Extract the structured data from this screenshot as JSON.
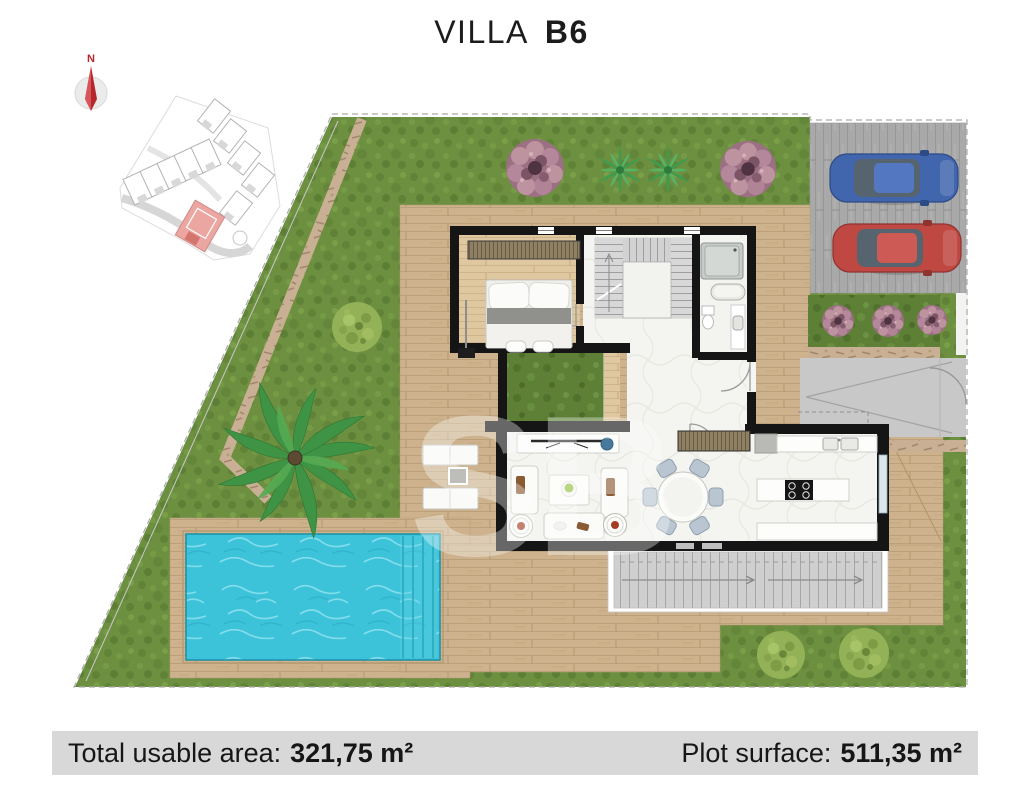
{
  "title": {
    "name": "VILLA",
    "unit": "B6"
  },
  "compass": {
    "label": "N"
  },
  "watermark": {
    "text": "SB"
  },
  "summary": {
    "usable_label": "Total usable area:",
    "usable_value": "321,75 m²",
    "plot_label": "Plot surface:",
    "plot_value": "511,35 m²"
  },
  "palette": {
    "grass": "#6d9040",
    "deck_wood": "#cdb28d",
    "pool_water": "#3cc2d9",
    "driveway": "#a9a9a9",
    "walls": "#151515",
    "compass_red": "#b5272c",
    "highlight_unit": "#eba6a1",
    "car_blue": "#4166ae",
    "car_red": "#bf4842",
    "bar_bg": "#d8d8d8"
  },
  "features": [
    "location-map",
    "compass",
    "lawn",
    "stone-path",
    "palm-tree",
    "swimming-pool",
    "wood-deck",
    "sun-loungers",
    "villa-floorplan",
    "bedroom",
    "staircase",
    "bathroom",
    "inner-courtyard",
    "living-room",
    "dining-table",
    "kitchen",
    "terrace",
    "driveway-parking",
    "cars",
    "garden-bushes"
  ]
}
